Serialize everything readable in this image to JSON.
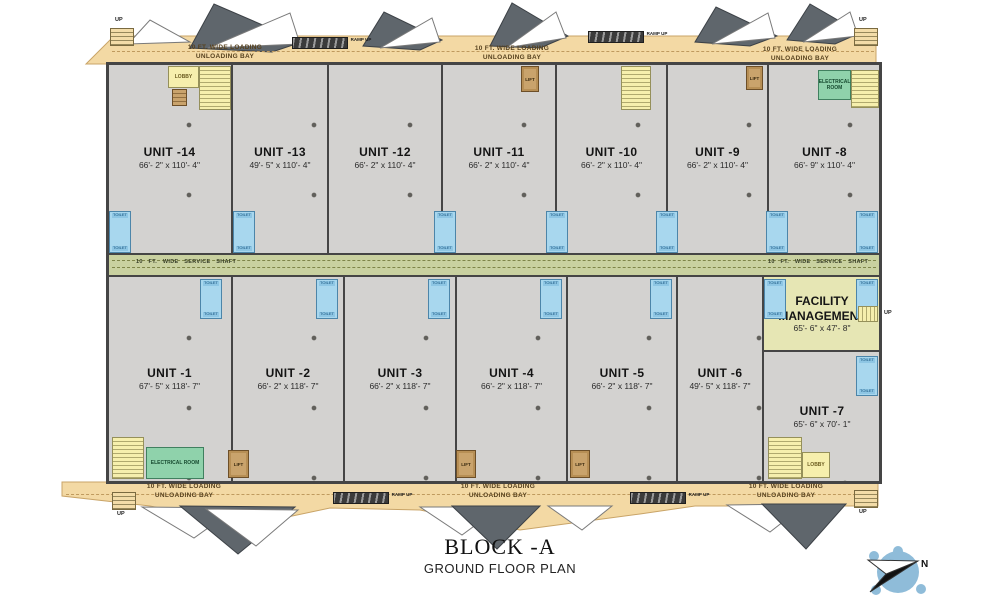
{
  "title": {
    "block": "BLOCK -A",
    "subtitle": "GROUND FLOOR PLAN"
  },
  "compass": {
    "north_label": "N"
  },
  "bays": {
    "loading_line1": "10 FT. WIDE LOADING",
    "loading_line2": "UNLOADING BAY",
    "ramp_up": "RAMP UP",
    "up": "UP"
  },
  "service_shaft_label": "10 FT. WIDE SERVICE SHAFT",
  "rooms": {
    "lobby": "LOBBY",
    "electrical": "ELECTRICAL ROOM",
    "lift": "LIFT",
    "toilet": "TOILET",
    "facility_name": "FACILITY MANAGEMENT",
    "facility_dims": "65'- 6\" x 47'- 8\""
  },
  "units_top": [
    {
      "name": "UNIT -14",
      "dims": "66'- 2\" x 110'- 4\""
    },
    {
      "name": "UNIT -13",
      "dims": "49'- 5\" x 110'- 4\""
    },
    {
      "name": "UNIT -12",
      "dims": "66'- 2\" x 110'- 4\""
    },
    {
      "name": "UNIT -11",
      "dims": "66'- 2\" x 110'- 4\""
    },
    {
      "name": "UNIT -10",
      "dims": "66'- 2\" x 110'- 4\""
    },
    {
      "name": "UNIT -9",
      "dims": "66'- 2\" x 110'- 4\""
    },
    {
      "name": "UNIT -8",
      "dims": "66'- 9\" x 110'- 4\""
    }
  ],
  "units_bottom": [
    {
      "name": "UNIT -1",
      "dims": "67'- 5\" x 118'- 7\""
    },
    {
      "name": "UNIT -2",
      "dims": "66'- 2\" x 118'- 7\""
    },
    {
      "name": "UNIT -3",
      "dims": "66'- 2\" x 118'- 7\""
    },
    {
      "name": "UNIT -4",
      "dims": "66'- 2\" x 118'- 7\""
    },
    {
      "name": "UNIT -5",
      "dims": "66'- 2\" x 118'- 7\""
    },
    {
      "name": "UNIT -6",
      "dims": "49'- 5\" x 118'- 7\""
    }
  ],
  "unit7": {
    "name": "UNIT -7",
    "dims": "65'- 6\" x 70'- 1\""
  }
}
